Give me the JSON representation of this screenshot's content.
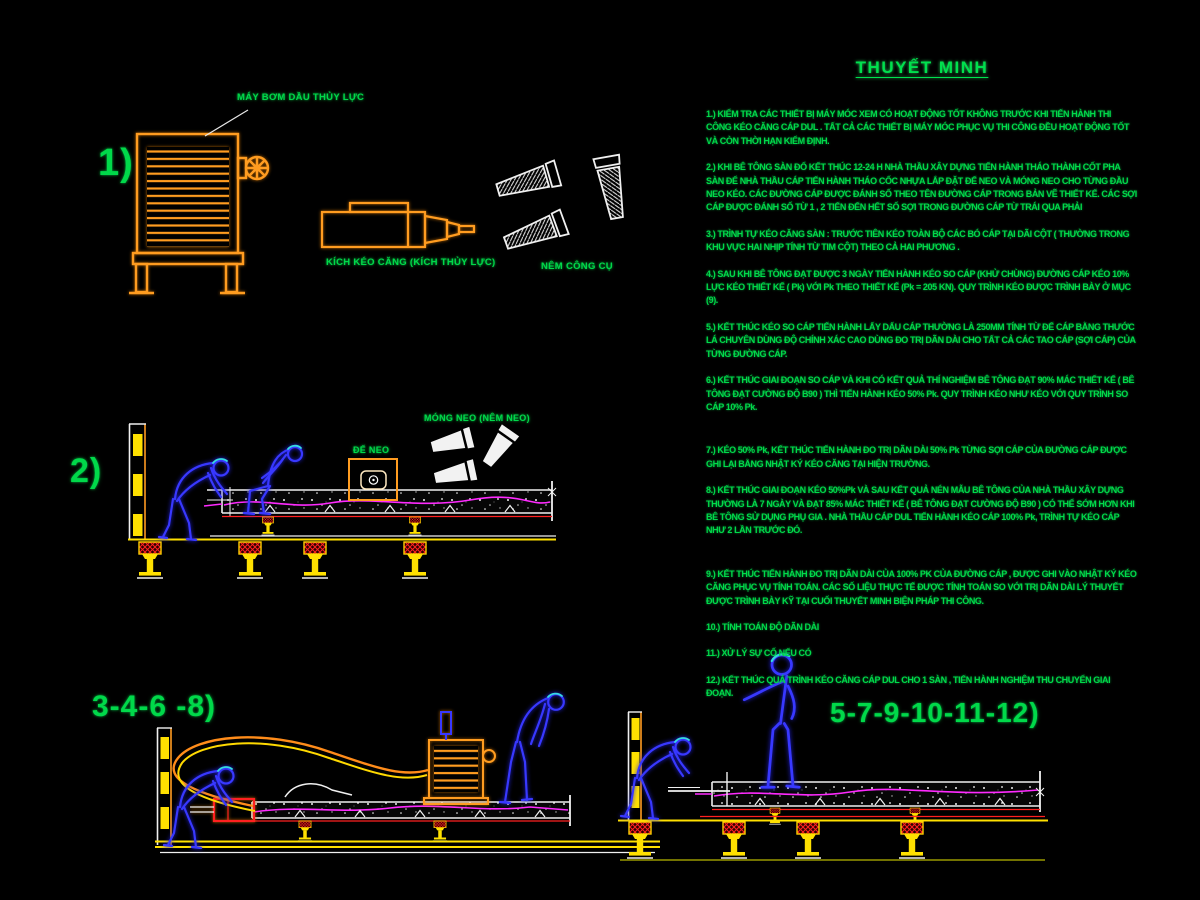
{
  "title": "THUYẾT MINH",
  "colors": {
    "background": "#000000",
    "annotation_green": "#00d94a",
    "machine_orange": "#ff9c20",
    "worker_blue": "#3838ff",
    "cable_magenta": "#ff2aff",
    "prop_red": "#ff2020",
    "prop_yellow": "#ffe000",
    "drawing_white": "#f0f0f0"
  },
  "sections": {
    "s1": {
      "number": "1)",
      "pump_label": "MÁY BƠM DẦU THỦY LỰC",
      "jack_label": "KÍCH KÉO CĂNG (KÍCH THỦY LỰC)",
      "wedge_label": "NÊM CÔNG CỤ"
    },
    "s2": {
      "number": "2)",
      "anchor_base_label": "ĐẾ NEO",
      "anchor_wedge_label": "MÓNG NEO (NÊM NEO)"
    },
    "s3": {
      "number": "3-4-6 -8)"
    },
    "s4": {
      "number": "5-7-9-10-11-12)"
    }
  },
  "notes": [
    "1.) KIỂM TRA CÁC THIẾT BỊ MÁY MÓC XEM CÓ HOẠT ĐỘNG TỐT KHÔNG TRƯỚC KHI TIẾN HÀNH THI CÔNG KÉO CĂNG CÁP DUL . TẤT CẢ CÁC THIẾT BỊ MÁY MÓC PHỤC VỤ THI CÔNG ĐỀU HOẠT ĐỘNG TỐT VÀ CÒN THỜI HẠN KIỂM ĐỊNH.",
    "2.) KHI BÊ TÔNG SÀN ĐỔ KẾT THÚC 12-24 H NHÀ THẦU XÂY DỰNG TIẾN HÀNH THÁO THÀNH CỐT PHA SÀN ĐỂ NHÀ THẦU CÁP TIẾN HÀNH THÁO CỐC NHỰA LẮP ĐẶT ĐẾ NEO VÀ MÓNG NEO CHO TỪNG ĐẦU NEO KÉO. CÁC ĐƯỜNG CÁP ĐƯỢC ĐÁNH SỐ THEO TÊN ĐƯỜNG CÁP TRONG BẢN VẼ THIẾT KẾ. CÁC SỢI CÁP ĐƯỢC ĐÁNH SỐ TỪ 1 , 2 TIẾN ĐẾN HẾT SỐ SỢI TRONG ĐƯỜNG CÁP TỪ TRÁI QUA PHẢI",
    "3.) TRÌNH TỰ KÉO CĂNG SÀN : TRƯỚC TIÊN KÉO TOÀN BỘ CÁC BÓ CÁP TẠI DÃI CỘT ( THƯỜNG TRONG KHU VỰC HAI NHỊP TÍNH TỪ TIM CỘT) THEO CẢ HAI PHƯƠNG .",
    "4.) SAU KHI BÊ TÔNG ĐẠT ĐƯỢC 3 NGÀY TIẾN HÀNH KÉO SO CÁP (KHỬ CHÙNG) ĐƯỜNG CÁP KÉO 10% LỰC KÉO THIẾT KẾ ( Pk) VỚI Pk THEO THIẾT KẾ (Pk = 205 KN). QUY TRÌNH KÉO ĐƯỢC TRÌNH BÀY Ở MỤC (9).",
    "5.) KẾT THÚC KÉO SO CÁP TIẾN HÀNH LẤY DẤU CÁP THƯỜNG LÀ 250MM TÍNH TỪ ĐẾ CÁP BẰNG THƯỚC LÁ CHUYÊN DÙNG ĐỘ CHÍNH XÁC CAO DÙNG ĐO TRỊ DÃN DÀI CHO TẤT CẢ CÁC TAO CÁP (SỢI CÁP) CỦA TỪNG ĐƯỜNG CÁP.",
    "6.) KẾT THÚC GIAI ĐOẠN SO CÁP VÀ KHI CÓ KẾT QUẢ THÍ NGHIỆM BÊ TÔNG ĐẠT 90% MÁC THIẾT KẾ ( BÊ TÔNG ĐẠT CƯỜNG ĐỘ B90 ) THÌ TIẾN HÀNH KÉO 50% Pk. QUY TRÌNH KÉO NHƯ KÉO VỚI QUY TRÌNH SO CÁP 10% Pk.",
    "7.) KÉO 50% Pk, KẾT THÚC TIẾN HÀNH ĐO TRỊ DÃN DÀI 50% Pk TỪNG SỢI CÁP CỦA ĐƯỜNG CÁP ĐƯỢC GHI LẠI BẰNG NHẬT KÝ KÉO CĂNG TẠI HIỆN TRƯỜNG.",
    "8.) KẾT THÚC GIAI ĐOẠN KÉO 50%Pk VÀ SAU KẾT QUẢ NÉN MẪU BÊ TÔNG CỦA NHÀ THẦU XÂY DỰNG THƯỜNG LÀ 7 NGÀY VÀ ĐẠT 85% MÁC THIẾT KẾ ( BÊ TÔNG ĐẠT CƯỜNG ĐỘ B90 ) CÓ THỂ SỚM HƠN KHI BÊ TÔNG SỬ DỤNG PHỤ GIA . NHÀ THẦU CÁP DUL TIẾN HÀNH KÉO CÁP 100% Pk,  TRÌNH TỰ KÉO CÁP NHƯ 2 LẦN TRƯỚC ĐÓ.",
    "9.) KẾT THÚC TIẾN HÀNH ĐO TRỊ DÃN DÀI CỦA 100% PK CỦA ĐƯỜNG CÁP , ĐƯỢC GHI VÀO NHẬT KÝ KÉO CĂNG PHỤC VỤ TÍNH TOÁN. CÁC SỐ LIỆU THỰC TẾ ĐƯỢC TÍNH TOÁN SO VỚI TRỊ DÃN DÀI LÝ THUYẾT ĐƯỢC TRÌNH BÀY KỸ TẠI CUỐI THUYẾT MINH BIỆN PHÁP THI CÔNG.",
    "10.) TÍNH TOÁN ĐỘ DÃN DÀI",
    "11.) XỬ LÝ SỰ CỐ NẾU CÓ",
    "12.) KẾT THÚC  QUÁ TRÌNH KÉO CĂNG CÁP DUL CHO 1 SÀN , TIẾN HÀNH NGHIỆM THU CHUYỂN GIAI ĐOẠN."
  ]
}
